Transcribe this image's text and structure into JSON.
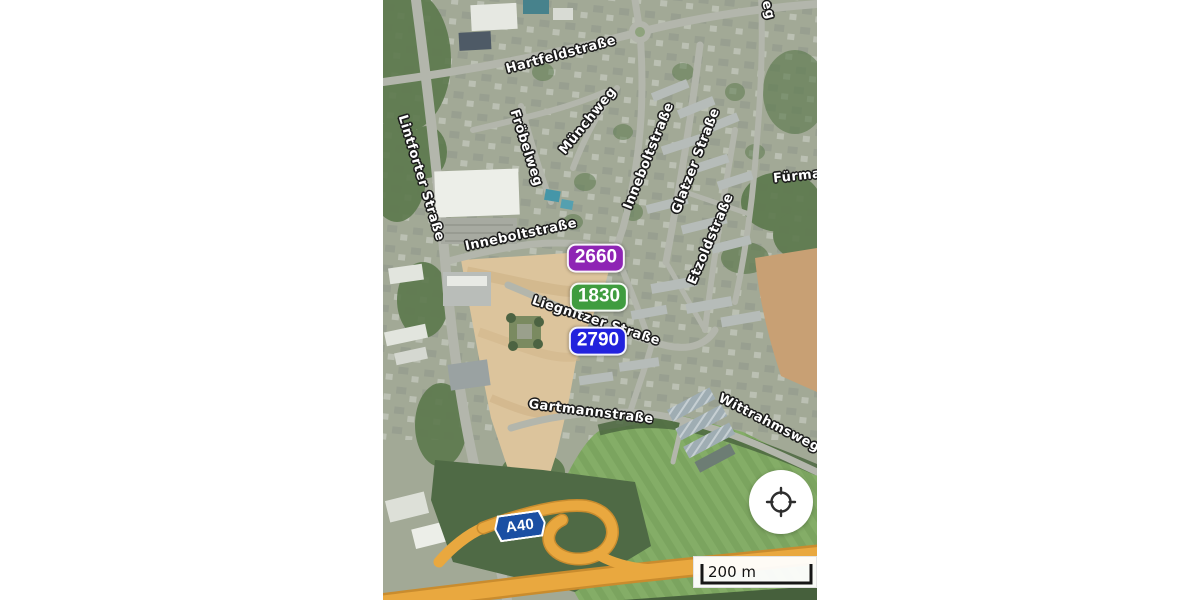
{
  "map": {
    "type": "satellite-view",
    "street_labels": [
      {
        "id": "hartfeldstrasse",
        "text": "Hartfeldstraße"
      },
      {
        "id": "froebelweg",
        "text": "Fröbelweg"
      },
      {
        "id": "muenchweg",
        "text": "Münchweg"
      },
      {
        "id": "inneboltstrasse-vertical",
        "text": "Inneboltstraße"
      },
      {
        "id": "glatzer-strasse",
        "text": "Glatzer Straße"
      },
      {
        "id": "lintforter-strasse",
        "text": "Lintforter Straße"
      },
      {
        "id": "inneboltstrasse-horizontal",
        "text": "Inneboltstraße"
      },
      {
        "id": "etzoldstrasse",
        "text": "Etzoldstraße"
      },
      {
        "id": "liegnitzer-strasse",
        "text": "Liegnitzer Straße"
      },
      {
        "id": "gartmannstrasse",
        "text": "Gartmannstraße"
      },
      {
        "id": "wittrahmsweg",
        "text": "Wittrahmsweg"
      },
      {
        "id": "fuerman-partial",
        "text": "Fürman"
      },
      {
        "id": "top-right-partial",
        "text": "eg"
      }
    ],
    "price_markers": [
      {
        "value": "2660",
        "color": "#8e24b4"
      },
      {
        "value": "1830",
        "color": "#3f9c3f"
      },
      {
        "value": "2790",
        "color": "#2222dd"
      }
    ],
    "highway_badge": {
      "label": "A40",
      "color": "#1a4fa3"
    },
    "scale_bar": {
      "label": "200 m"
    },
    "controls": {
      "locate_icon": "crosshair-locate-icon"
    }
  }
}
